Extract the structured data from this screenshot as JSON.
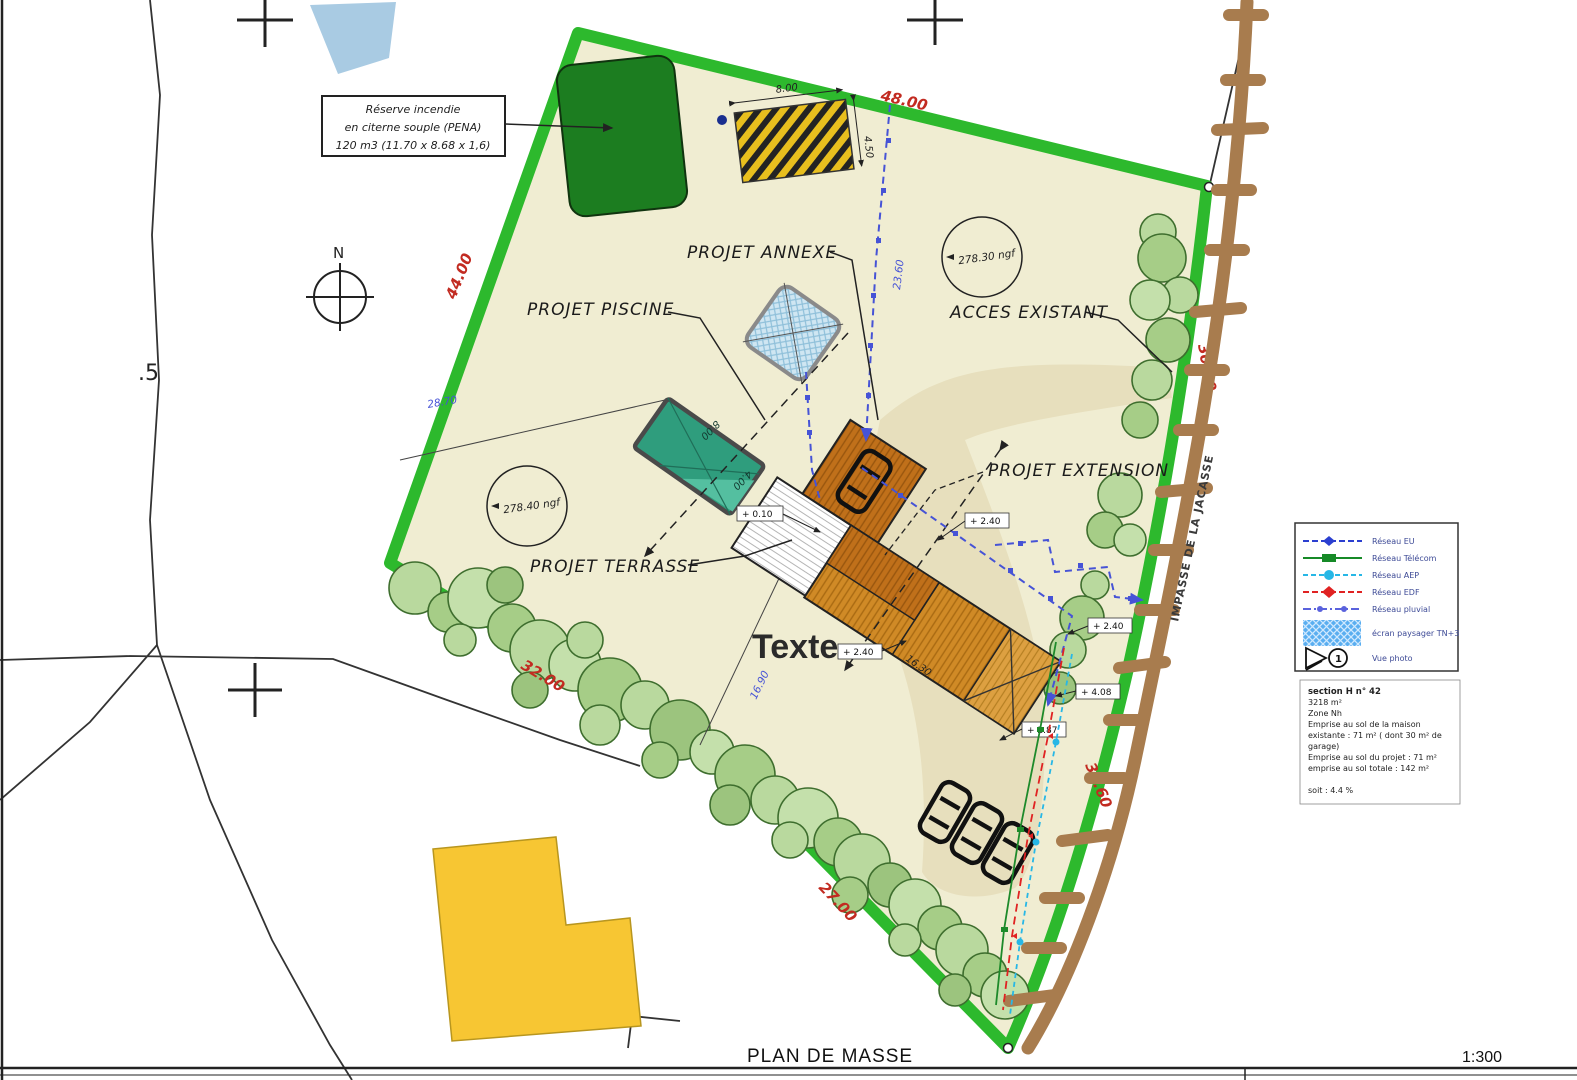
{
  "meta": {
    "drawing_title": "PLAN DE MASSE",
    "scale": "1:300"
  },
  "note_box": {
    "line1": "Réserve incendie",
    "line2": "en citerne souple (PENA)",
    "line3": "120 m3 (11.70 x 8.68 x 1,6)"
  },
  "north_label": "N",
  "street_name": "IMPASSE DE LA JACASSE",
  "parcel_fragment": ".5",
  "free_text": "Texte",
  "labels": {
    "annexe": "PROJET ANNEXE",
    "piscine": "PROJET PISCINE",
    "acces": "ACCES EXISTANT",
    "extension": "PROJET EXTENSION",
    "terrasse": "PROJET TERRASSE"
  },
  "levels": {
    "ngf_ne": "278.30 ngf",
    "ngf_w": "278.40 ngf"
  },
  "boundary_dims": {
    "north": "48.00",
    "northwest": "44.00",
    "east": "30.00",
    "southwest": "32.00",
    "south": "27.00",
    "road": "36.60"
  },
  "blue_dims": {
    "d1": "23.60",
    "d2": "16.90",
    "d3": "28.70"
  },
  "black_dims": {
    "building_length": "16.30",
    "pena_w": "8.00",
    "pena_h": "4.50",
    "pool_l": "8.00",
    "pool_w": "4.00"
  },
  "elevations": {
    "terrace": "+ 0.10",
    "e1": "+ 2.40",
    "e2": "+ 2.40",
    "e3": "+ 2.40",
    "e4": "+ 4.08",
    "e5": "+ 2.87"
  },
  "legend": {
    "items": [
      {
        "label": "Réseau EU",
        "color": "#2b3fd0"
      },
      {
        "label": "Réseau Télécom",
        "color": "#168a27"
      },
      {
        "label": "Réseau AEP",
        "color": "#27b7e6"
      },
      {
        "label": "Réseau EDF",
        "color": "#e02222"
      },
      {
        "label": "Réseau pluvial",
        "color": "#5a62dd"
      }
    ],
    "hatch_label": "écran paysager TN+3",
    "photo_label": "Vue photo",
    "photo_number": "1"
  },
  "info_box": {
    "lines": [
      "section H n° 42",
      "3218 m²",
      "Zone Nh",
      "Emprise au sol de la maison",
      "existante : 71 m² ( dont 30 m² de",
      "garage)",
      "Emprise au sol du projet : 71 m²",
      "emprise au sol totale : 142 m²",
      "",
      "soit : 4.4 %"
    ]
  },
  "colors": {
    "parcel_fill": "#f0edd2",
    "boundary_green": "#2db92d",
    "tree_fill": "#b9d99e",
    "pool_teal": "#2f9d7d",
    "building_orange": "#d08a26",
    "reserve_green": "#1c7d20",
    "road_brown": "#a87c4e",
    "dim_red": "#c22b21",
    "dim_blue": "#4653d6",
    "driveway_tan": "#e7dfbd",
    "yellow_building": "#f7c633",
    "annexe_blue": "#cfe6f2"
  }
}
